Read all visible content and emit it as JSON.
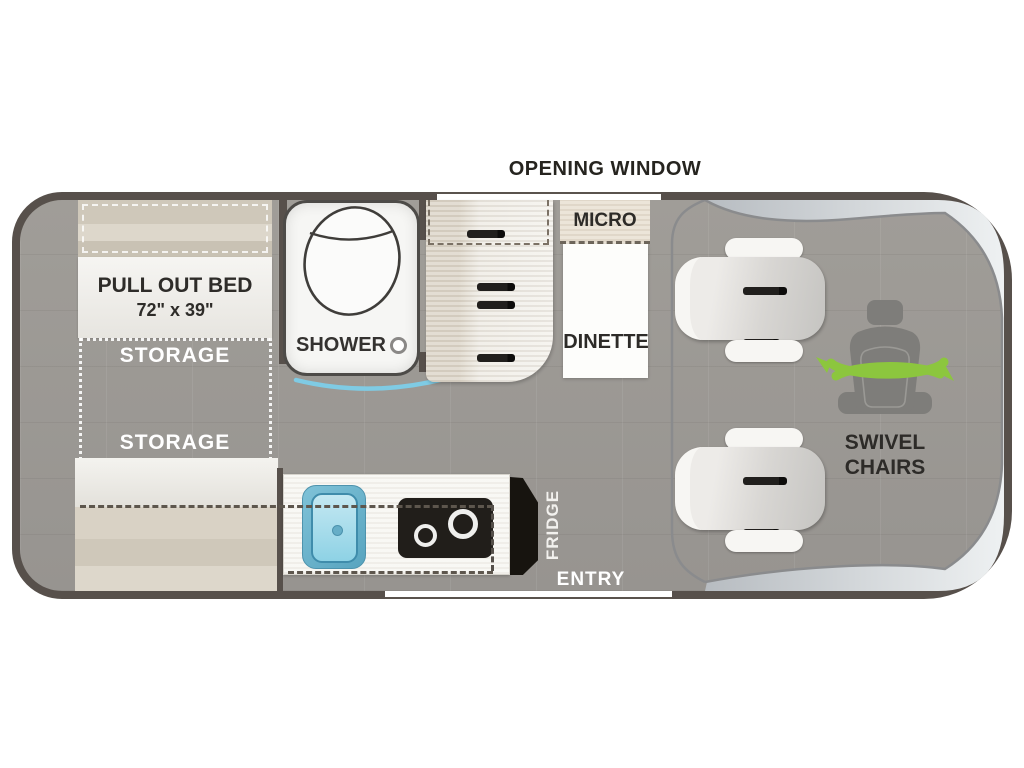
{
  "window_label": "OPENING WINDOW",
  "bedroom": {
    "bed_title": "PULL OUT BED",
    "bed_size": "72\" x 39\"",
    "storage_top": "STORAGE",
    "storage_bottom": "STORAGE"
  },
  "bath": {
    "shower": "SHOWER"
  },
  "kitchen": {
    "micro": "MICRO",
    "dinette": "DINETTE",
    "fridge": "FRIDGE",
    "entry": "ENTRY"
  },
  "cab": {
    "swivel_line1": "SWIVEL",
    "swivel_line2": "CHAIRS"
  },
  "icons": {
    "toilet": "toilet-icon",
    "shower_drain": "shower-drain-icon",
    "sink_drain": "sink-drain-icon",
    "burners": "burner-icon",
    "swivel_seat": "seat-swivel-icon",
    "swivel_arrows": "swivel-arrows-icon"
  },
  "colors": {
    "wall": "#57504b",
    "floor": "#9c9994",
    "cushion_tan": "#d7d0c3",
    "mattress_white": "#f5f4f1",
    "accent_green": "#8cc63e",
    "curtain_blue": "#7fcbe4",
    "sink_blue": "#8ed2e5",
    "appliance_black": "#211e1a",
    "glass_light": "#eef1f2"
  }
}
